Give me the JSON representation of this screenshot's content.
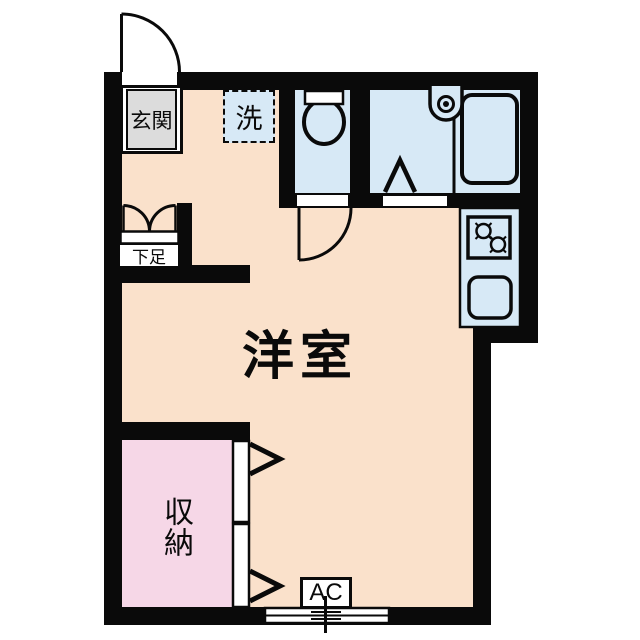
{
  "title": "studio-apartment-floorplan",
  "rooms": {
    "entrance": {
      "label": "玄関"
    },
    "washer": {
      "label": "洗"
    },
    "shoe_cabinet": {
      "label": "下足"
    },
    "main_room": {
      "label": "洋室"
    },
    "closet": {
      "label": "収納"
    },
    "ac_unit": {
      "label": "AC"
    }
  },
  "icons": {
    "toilet": "toilet-icon",
    "bathtub": "bathtub-icon",
    "bath_faucet": "faucet-icon",
    "stove": "two-burner-stove-icon",
    "sink": "kitchen-sink-icon",
    "entrance_door": "swing-door-arc",
    "interior_door": "swing-door-arc",
    "closet_doors": "sliding-door-chevrons",
    "window": "double-sliding-window"
  },
  "colors": {
    "wall": "#0a0a0a",
    "floor_main": "#fae1cb",
    "floor_wet": "#d7e9f6",
    "floor_closet": "#f6d7e7",
    "floor_entrance": "#dcdcdc",
    "outline": "#ffffff"
  }
}
